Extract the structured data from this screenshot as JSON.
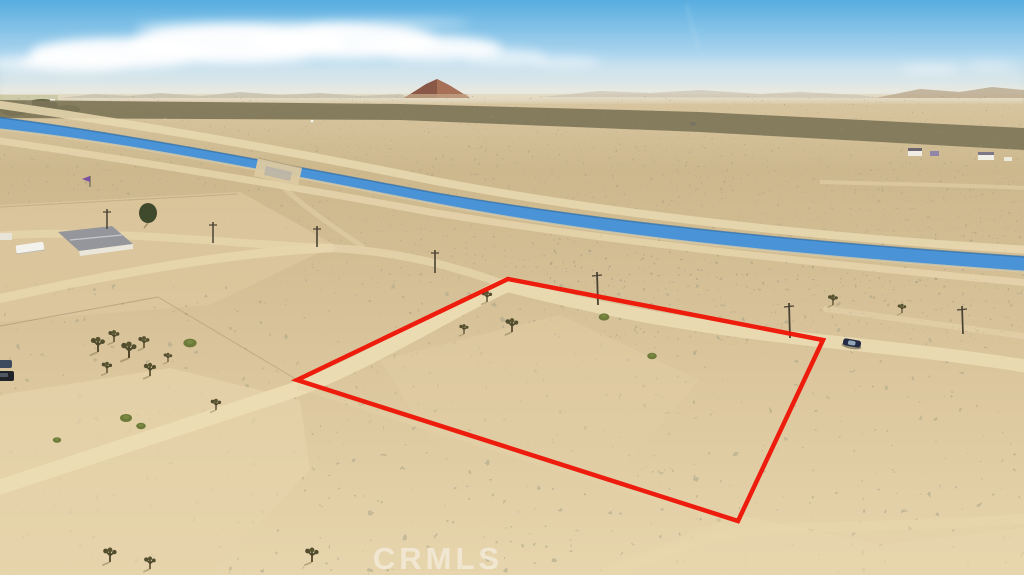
{
  "watermark": {
    "text": "CRMLS",
    "color": "#ffffff",
    "opacity": 0.45
  },
  "parcel_overlay": {
    "points": "297,380 508,279 823,340 738,521",
    "stroke_color": "#ee1507",
    "stroke_width": 4.5
  },
  "scene": {
    "sky_top_color": "#57ade0",
    "sky_mid_color": "#aed6ee",
    "sky_horizon_color": "#e9e6d9",
    "water_color": "#4a93d6",
    "road_color": "#ecdcb4",
    "brush_color": "#7c7457",
    "butte_color": "#8a5847"
  }
}
